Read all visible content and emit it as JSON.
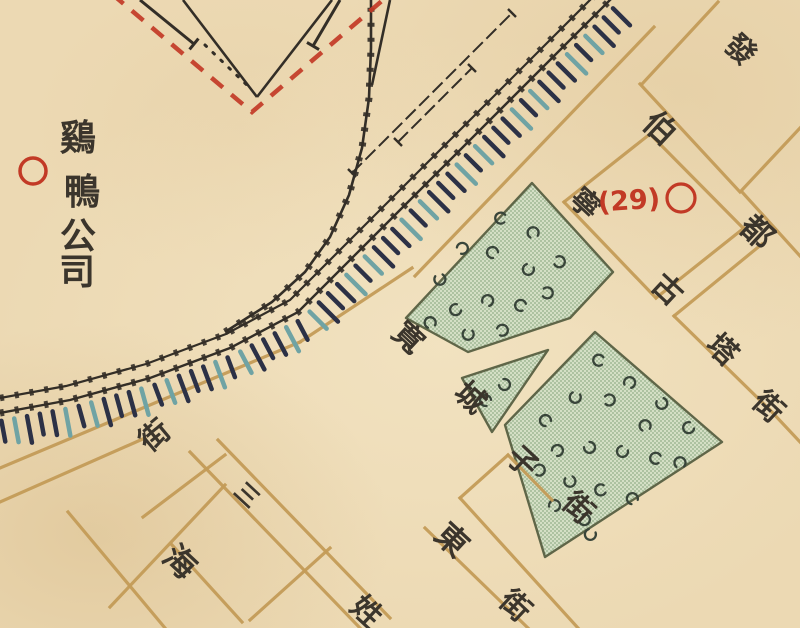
{
  "map": {
    "colors": {
      "paper": "#ecd9b3",
      "ink": "#3b352c",
      "rail": "#332e27",
      "street": "#c49c58",
      "red": "#c23a26",
      "hatch_navy": "#2c3146",
      "hatch_teal": "#6fa3a4",
      "block_fill": "#d4dfc5",
      "block_dot": "#92ad87",
      "block_border": "#5f6648",
      "garden_mark": "#39453a"
    },
    "company": {
      "name": "鷄鴨公司",
      "chars": [
        {
          "t": "鷄",
          "x": 78,
          "y": 138
        },
        {
          "t": "鴨",
          "x": 82,
          "y": 192
        },
        {
          "t": "公",
          "x": 78,
          "y": 236
        },
        {
          "t": "司",
          "x": 77,
          "y": 272
        }
      ],
      "size": 36,
      "circle": {
        "x": 33,
        "y": 171,
        "r": 13
      }
    },
    "marker29": {
      "text": "(29)",
      "x": 629,
      "y": 201,
      "size": 27,
      "circle": {
        "x": 681,
        "y": 198,
        "r": 14
      }
    },
    "street_labels": [
      {
        "t": "發",
        "x": 740,
        "y": 50,
        "rot": 43,
        "size": 30
      },
      {
        "t": "伯",
        "x": 660,
        "y": 128,
        "rot": 43,
        "size": 32
      },
      {
        "t": "都",
        "x": 757,
        "y": 232,
        "rot": 43,
        "size": 32
      },
      {
        "t": "寧",
        "x": 585,
        "y": 204,
        "rot": 43,
        "size": 30
      },
      {
        "t": "古",
        "x": 667,
        "y": 290,
        "rot": 43,
        "size": 30
      },
      {
        "t": "塔",
        "x": 722,
        "y": 350,
        "rot": 43,
        "size": 30
      },
      {
        "t": "街",
        "x": 768,
        "y": 407,
        "rot": 43,
        "size": 30
      },
      {
        "t": "寬",
        "x": 408,
        "y": 338,
        "rot": 43,
        "size": 30
      },
      {
        "t": "城",
        "x": 470,
        "y": 398,
        "rot": 43,
        "size": 30
      },
      {
        "t": "子",
        "x": 522,
        "y": 462,
        "rot": 43,
        "size": 30
      },
      {
        "t": "街",
        "x": 578,
        "y": 508,
        "rot": 43,
        "size": 30
      },
      {
        "t": "三",
        "x": 246,
        "y": 496,
        "rot": 43,
        "size": 24
      },
      {
        "t": "姓",
        "x": 366,
        "y": 612,
        "rot": 43,
        "size": 30
      },
      {
        "t": "東",
        "x": 452,
        "y": 540,
        "rot": 43,
        "size": 32
      },
      {
        "t": "街",
        "x": 515,
        "y": 606,
        "rot": 43,
        "size": 30
      },
      {
        "t": "海",
        "x": 180,
        "y": 562,
        "rot": 43,
        "size": 32
      },
      {
        "t": "街",
        "x": 155,
        "y": 436,
        "rot": -40,
        "size": 30
      }
    ],
    "railway": {
      "main": [
        [
          0,
          413
        ],
        [
          70,
          400
        ],
        [
          150,
          378
        ],
        [
          230,
          348
        ],
        [
          298,
          312
        ],
        [
          625,
          -15
        ]
      ],
      "second": [
        [
          0,
          398
        ],
        [
          66,
          386
        ],
        [
          146,
          364
        ],
        [
          226,
          334
        ],
        [
          290,
          300
        ],
        [
          612,
          -22
        ]
      ],
      "yard_curve": [
        [
          225,
          332
        ],
        [
          272,
          302
        ],
        [
          305,
          272
        ],
        [
          330,
          237
        ],
        [
          349,
          195
        ],
        [
          362,
          148
        ],
        [
          369,
          98
        ],
        [
          371,
          48
        ],
        [
          371,
          0
        ]
      ],
      "sidings": [
        {
          "pts": [
            [
              352,
              173
            ],
            [
              512,
              13
            ]
          ]
        },
        {
          "pts": [
            [
              398,
              142
            ],
            [
              472,
              68
            ]
          ]
        }
      ],
      "yard_lines": [
        [
          [
            390,
            0
          ],
          [
            372,
            85
          ]
        ],
        [
          [
            183,
            0
          ],
          [
            257,
            97
          ]
        ],
        [
          [
            257,
            97
          ],
          [
            332,
            0
          ]
        ]
      ],
      "dotdash": [
        [
          205,
          45
        ],
        [
          250,
          88
        ]
      ],
      "spurs": [
        {
          "pts": [
            [
              140,
              0
            ],
            [
              194,
              44
            ]
          ]
        },
        {
          "pts": [
            [
              340,
              0
            ],
            [
              313,
              46
            ]
          ]
        }
      ]
    },
    "embankment": {
      "spacing": 13,
      "offset": 8,
      "len": 24,
      "width": 4.5,
      "palette": [
        "#2c3146",
        "#6fa3a4"
      ]
    },
    "boundary": {
      "points": [
        [
          112,
          -6
        ],
        [
          252,
          112
        ],
        [
          390,
          -6
        ]
      ],
      "dash": "15 11",
      "width": 4.5
    },
    "streets": [
      [
        718,
        2,
        642,
        84
      ],
      [
        742,
        190,
        800,
        128
      ],
      [
        650,
        134,
        564,
        202
      ],
      [
        656,
        298,
        744,
        228
      ],
      [
        762,
        244,
        674,
        316
      ],
      [
        415,
        276,
        654,
        27
      ],
      [
        0,
        468,
        300,
        342
      ],
      [
        300,
        342,
        412,
        268
      ],
      [
        0,
        502,
        145,
        438
      ],
      [
        143,
        517,
        225,
        455
      ],
      [
        110,
        607,
        225,
        485
      ],
      [
        250,
        620,
        330,
        548
      ],
      [
        460,
        498,
        508,
        455
      ],
      [
        508,
        455,
        552,
        500
      ],
      [
        640,
        84,
        740,
        192
      ],
      [
        742,
        192,
        800,
        256
      ],
      [
        650,
        134,
        743,
        228
      ],
      [
        564,
        202,
        656,
        298
      ],
      [
        674,
        316,
        770,
        410
      ],
      [
        770,
        410,
        800,
        442
      ],
      [
        218,
        440,
        390,
        618
      ],
      [
        190,
        452,
        360,
        628
      ],
      [
        172,
        545,
        242,
        622
      ],
      [
        68,
        512,
        165,
        628
      ],
      [
        425,
        528,
        528,
        628
      ],
      [
        460,
        498,
        578,
        628
      ]
    ],
    "blocks": {
      "upper": {
        "pts": [
          [
            532,
            183
          ],
          [
            613,
            272
          ],
          [
            570,
            318
          ],
          [
            468,
            352
          ],
          [
            406,
            318
          ]
        ],
        "marks": [
          [
            500,
            218,
            10
          ],
          [
            533,
            232,
            80
          ],
          [
            560,
            262,
            200
          ],
          [
            528,
            270,
            300
          ],
          [
            492,
            252,
            45
          ],
          [
            463,
            248,
            150
          ],
          [
            440,
            280,
            260
          ],
          [
            455,
            310,
            330
          ],
          [
            488,
            300,
            120
          ],
          [
            520,
            305,
            30
          ],
          [
            548,
            293,
            190
          ],
          [
            430,
            322,
            75
          ],
          [
            468,
            335,
            280
          ],
          [
            503,
            330,
            160
          ]
        ]
      },
      "triangle": {
        "pts": [
          [
            548,
            350
          ],
          [
            462,
            378
          ],
          [
            492,
            432
          ]
        ],
        "marks": [
          [
            505,
            385,
            220
          ],
          [
            485,
            400,
            40
          ]
        ]
      },
      "lower": {
        "pts": [
          [
            595,
            332
          ],
          [
            722,
            442
          ],
          [
            545,
            557
          ],
          [
            505,
            425
          ]
        ],
        "marks": [
          [
            598,
            360,
            15
          ],
          [
            630,
            382,
            120
          ],
          [
            662,
            404,
            250
          ],
          [
            688,
            428,
            330
          ],
          [
            645,
            425,
            80
          ],
          [
            610,
            400,
            180
          ],
          [
            575,
            398,
            290
          ],
          [
            545,
            420,
            50
          ],
          [
            558,
            450,
            140
          ],
          [
            590,
            448,
            230
          ],
          [
            622,
            452,
            310
          ],
          [
            655,
            458,
            20
          ],
          [
            680,
            462,
            90
          ],
          [
            540,
            470,
            170
          ],
          [
            570,
            482,
            260
          ],
          [
            600,
            490,
            350
          ],
          [
            632,
            498,
            60
          ],
          [
            555,
            505,
            130
          ],
          [
            585,
            520,
            210
          ],
          [
            590,
            535,
            300
          ]
        ]
      }
    }
  }
}
